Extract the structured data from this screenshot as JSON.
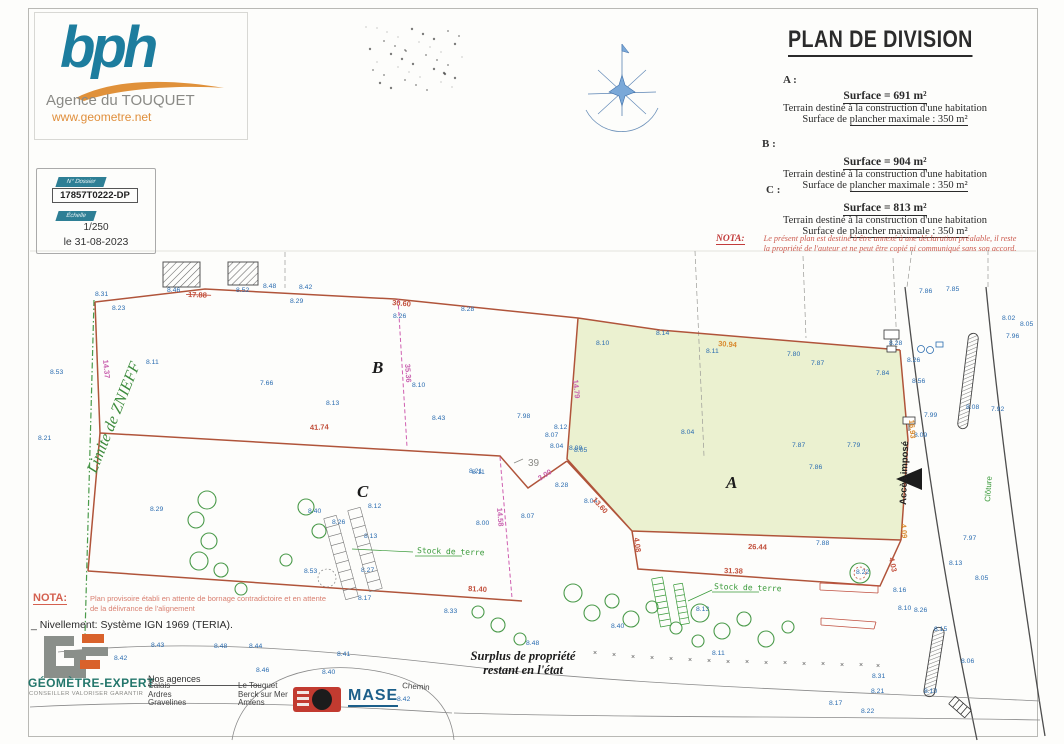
{
  "header": {
    "logo": "bph",
    "agency": "Agence du TOUQUET",
    "website": "www.geometre.net"
  },
  "project_box": {
    "dossier_label": "N° Dossier",
    "dossier_value": "17857T0222-DP",
    "scale_label": "Échelle",
    "scale_value": "1/250",
    "date": "le 31-08-2023"
  },
  "title_block": {
    "title": "PLAN DE DIVISION",
    "parcels": [
      {
        "id": "A :",
        "surface": "Surface = 691 m²",
        "line1": "Terrain destiné à la construction d'une habitation",
        "line2a": "Surface de ",
        "line2b": "plancher maximale : 350 m²"
      },
      {
        "id": "B :",
        "surface": "Surface = 904 m²",
        "line1": "Terrain destiné à la construction d'une habitation",
        "line2a": "Surface de ",
        "line2b": "plancher maximale : 350 m²"
      },
      {
        "id": "C :",
        "surface": "Surface = 813 m²",
        "line1": "Terrain destiné à la construction d'une habitation",
        "line2a": "Surface de ",
        "line2b": "plancher maximale : 350 m²"
      }
    ],
    "nota_label": "NOTA:",
    "nota_line1": "Le présent plan est destiné à être annexé à une déclaration préalable, il reste",
    "nota_line2": "la propriété de l'auteur et ne peut être copié ni communiqué sans son accord."
  },
  "plan": {
    "parcel_labels": [
      {
        "t": "B",
        "x": 372,
        "y": 373,
        "s": 16
      },
      {
        "t": "C",
        "x": 357,
        "y": 497,
        "s": 16
      },
      {
        "t": "A",
        "x": 726,
        "y": 488,
        "s": 18
      }
    ],
    "parcel_number": {
      "t": "39",
      "x": 528,
      "y": 466
    },
    "annotations": [
      {
        "t": "Limite de ZNIEFF",
        "x": 96,
        "y": 474,
        "rot": -68,
        "cls": "zniff"
      },
      {
        "t": "Stock de terre",
        "x": 417,
        "y": 553,
        "rot": 2,
        "cls": "stock"
      },
      {
        "t": "Stock de terre",
        "x": 714,
        "y": 589,
        "rot": 2,
        "cls": "stock"
      },
      {
        "t": "Clôture",
        "x": 990,
        "y": 502,
        "rot": -86,
        "cls": "cloture"
      },
      {
        "t": "Accès imposé",
        "x": 906,
        "y": 505,
        "rot": -88,
        "cls": "acces"
      },
      {
        "t": "Chemin",
        "x": 402,
        "y": 688,
        "rot": 4,
        "cls": "cheminlbl"
      }
    ],
    "measurements": [
      {
        "t": "41.74",
        "x": 310,
        "y": 430,
        "rot": -2,
        "c": "m-red"
      },
      {
        "t": "30.60",
        "x": 392,
        "y": 305,
        "rot": 5,
        "c": "m-red"
      },
      {
        "t": "17.88",
        "x": 188,
        "y": 297,
        "rot": 2,
        "c": "m-red",
        "strike": true
      },
      {
        "t": "30.94",
        "x": 718,
        "y": 346,
        "rot": 4,
        "c": "m-org"
      },
      {
        "t": "14.79",
        "x": 573,
        "y": 380,
        "rot": 84,
        "c": "m-mag"
      },
      {
        "t": "35.36",
        "x": 405,
        "y": 364,
        "rot": 86,
        "c": "m-mag"
      },
      {
        "t": "14.37",
        "x": 103,
        "y": 360,
        "rot": 84,
        "c": "m-mag"
      },
      {
        "t": "26.44",
        "x": 748,
        "y": 549,
        "rot": 2,
        "c": "m-red"
      },
      {
        "t": "31.38",
        "x": 724,
        "y": 573,
        "rot": 2,
        "c": "m-red"
      },
      {
        "t": "81.40",
        "x": 468,
        "y": 591,
        "rot": 3,
        "c": "m-red"
      },
      {
        "t": "13.60",
        "x": 592,
        "y": 500,
        "rot": 48,
        "c": "m-red"
      },
      {
        "t": "3.00",
        "x": 540,
        "y": 481,
        "rot": -33,
        "c": "m-mag"
      },
      {
        "t": "14.58",
        "x": 497,
        "y": 508,
        "rot": 85,
        "c": "m-mag"
      },
      {
        "t": "4.08",
        "x": 634,
        "y": 538,
        "rot": 82,
        "c": "m-red"
      },
      {
        "t": "16.93",
        "x": 909,
        "y": 420,
        "rot": 85,
        "c": "m-org"
      },
      {
        "t": "4.09",
        "x": 901,
        "y": 524,
        "rot": 85,
        "c": "m-org"
      },
      {
        "t": "4.03",
        "x": 889,
        "y": 558,
        "rot": 78,
        "c": "m-red"
      }
    ],
    "elevations": [
      [
        "8.31",
        95,
        296
      ],
      [
        "8.23",
        112,
        310
      ],
      [
        "8.46",
        167,
        292
      ],
      [
        "8.52",
        236,
        292
      ],
      [
        "8.48",
        263,
        288
      ],
      [
        "8.42",
        299,
        289
      ],
      [
        "8.29",
        290,
        303
      ],
      [
        "8.26",
        393,
        318
      ],
      [
        "8.28",
        461,
        311
      ],
      [
        "8.53",
        50,
        374
      ],
      [
        "8.11",
        146,
        364
      ],
      [
        "7.66",
        260,
        385
      ],
      [
        "8.13",
        326,
        405
      ],
      [
        "8.10",
        412,
        387
      ],
      [
        "8.43",
        432,
        420
      ],
      [
        "8.21",
        38,
        440
      ],
      [
        "8.10",
        596,
        345
      ],
      [
        "8.14",
        656,
        335
      ],
      [
        "8.11",
        706,
        353
      ],
      [
        "7.80",
        787,
        356
      ],
      [
        "7.87",
        811,
        365
      ],
      [
        "7.84",
        876,
        375
      ],
      [
        "8.04",
        681,
        434
      ],
      [
        "7.87",
        792,
        447
      ],
      [
        "7.79",
        847,
        447
      ],
      [
        "7.86",
        809,
        469
      ],
      [
        "8.08",
        569,
        450
      ],
      [
        "7.88",
        816,
        545
      ],
      [
        "7.98",
        517,
        418
      ],
      [
        "8.12",
        554,
        429
      ],
      [
        "8.07",
        545,
        437
      ],
      [
        "8.04",
        550,
        448
      ],
      [
        "8.05",
        574,
        452
      ],
      [
        "8.28",
        555,
        487
      ],
      [
        "8.04",
        584,
        503
      ],
      [
        "8.11",
        472,
        474
      ],
      [
        "8.07",
        521,
        518
      ],
      [
        "8.00",
        476,
        525
      ],
      [
        "8.29",
        150,
        511
      ],
      [
        "8.40",
        308,
        513
      ],
      [
        "8.26",
        332,
        524
      ],
      [
        "8.12",
        368,
        508
      ],
      [
        "8.13",
        364,
        538
      ],
      [
        "8.27",
        361,
        572
      ],
      [
        "8.53",
        304,
        573
      ],
      [
        "8.21",
        469,
        473
      ],
      [
        "8.17",
        358,
        600
      ],
      [
        "7.86",
        919,
        293
      ],
      [
        "7.85",
        946,
        291
      ],
      [
        "8.02",
        1002,
        320
      ],
      [
        "8.05",
        1020,
        326
      ],
      [
        "7.96",
        1006,
        338
      ],
      [
        "8.28",
        889,
        345
      ],
      [
        "8.26",
        907,
        362
      ],
      [
        "8.56",
        912,
        383
      ],
      [
        "7.99",
        924,
        417
      ],
      [
        "8.08",
        966,
        409
      ],
      [
        "7.92",
        991,
        411
      ],
      [
        "8.09",
        914,
        437
      ],
      [
        "7.97",
        963,
        540
      ],
      [
        "8.13",
        949,
        565
      ],
      [
        "8.05",
        975,
        580
      ],
      [
        "8.22",
        856,
        574
      ],
      [
        "8.16",
        893,
        592
      ],
      [
        "8.10",
        898,
        610
      ],
      [
        "8.26",
        914,
        612
      ],
      [
        "8.15",
        934,
        631
      ],
      [
        "8.06",
        961,
        663
      ],
      [
        "8.31",
        872,
        678
      ],
      [
        "8.21",
        871,
        693
      ],
      [
        "8.10",
        924,
        693
      ],
      [
        "8.17",
        829,
        705
      ],
      [
        "8.22",
        861,
        713
      ],
      [
        "8.42",
        114,
        660
      ],
      [
        "8.43",
        151,
        647
      ],
      [
        "8.48",
        214,
        648
      ],
      [
        "8.44",
        249,
        648
      ],
      [
        "8.41",
        337,
        656
      ],
      [
        "8.46",
        256,
        672
      ],
      [
        "8.40",
        322,
        674
      ],
      [
        "8.33",
        444,
        613
      ],
      [
        "8.48",
        526,
        645
      ],
      [
        "8.42",
        397,
        701
      ],
      [
        "8.13",
        696,
        611
      ],
      [
        "8.40",
        611,
        628
      ],
      [
        "8.11",
        712,
        655
      ]
    ],
    "trees": [
      [
        207,
        500,
        9
      ],
      [
        196,
        520,
        8
      ],
      [
        209,
        541,
        8
      ],
      [
        199,
        561,
        9
      ],
      [
        221,
        570,
        7
      ],
      [
        306,
        507,
        8
      ],
      [
        319,
        531,
        7
      ],
      [
        286,
        560,
        6
      ],
      [
        241,
        589,
        6
      ],
      [
        478,
        612,
        6
      ],
      [
        498,
        625,
        7
      ],
      [
        520,
        639,
        6
      ],
      [
        573,
        593,
        9
      ],
      [
        592,
        613,
        8
      ],
      [
        612,
        601,
        7
      ],
      [
        631,
        619,
        8
      ],
      [
        652,
        607,
        6
      ],
      [
        676,
        628,
        6
      ],
      [
        700,
        613,
        9
      ],
      [
        722,
        631,
        8
      ],
      [
        744,
        619,
        7
      ],
      [
        766,
        639,
        8
      ],
      [
        788,
        627,
        6
      ],
      [
        698,
        641,
        6
      ],
      [
        860,
        573,
        10
      ]
    ],
    "xmarks": [
      [
        593,
        655
      ],
      [
        612,
        657
      ],
      [
        631,
        659
      ],
      [
        650,
        660
      ],
      [
        669,
        661
      ],
      [
        688,
        662
      ],
      [
        707,
        663
      ],
      [
        726,
        664
      ],
      [
        745,
        664
      ],
      [
        764,
        665
      ],
      [
        783,
        665
      ],
      [
        802,
        666
      ],
      [
        821,
        666
      ],
      [
        840,
        667
      ],
      [
        859,
        667
      ],
      [
        876,
        668
      ]
    ]
  },
  "notes": {
    "nota_label": "NOTA:",
    "nota_line1": "Plan provisoire établi en attente de bornage contradictoire et en attente",
    "nota_line2": "de la délivrance de l'alignement",
    "nivellement": "_ Nivellement: Système IGN 1969 (TERIA).",
    "surplus_line1": "Surplus de propriété",
    "surplus_line2": "restant en l'état"
  },
  "footer": {
    "ge_name": "GÉOMÈTRE-EXPERT",
    "ge_tagline": "CONSEILLER VALORISER GARANTIR",
    "agencies_title": "Nos agences",
    "agencies_col1": [
      "Calais",
      "Ardres",
      "Gravelines"
    ],
    "agencies_col2": [
      "Le Touquet",
      "Berck sur Mer",
      "Amiens"
    ],
    "mase": "MASE"
  },
  "colors": {
    "accent_teal": "#1d7d9e",
    "accent_orange": "#e08f3c",
    "boundary_red": "#b0543a",
    "division_magenta": "#cf5fb0",
    "zniff_green": "#3d8b3d",
    "elevation_blue": "#2a6cb0",
    "note_red": "#cc5a4e",
    "parcel_a_fill": "#e9efcb"
  }
}
